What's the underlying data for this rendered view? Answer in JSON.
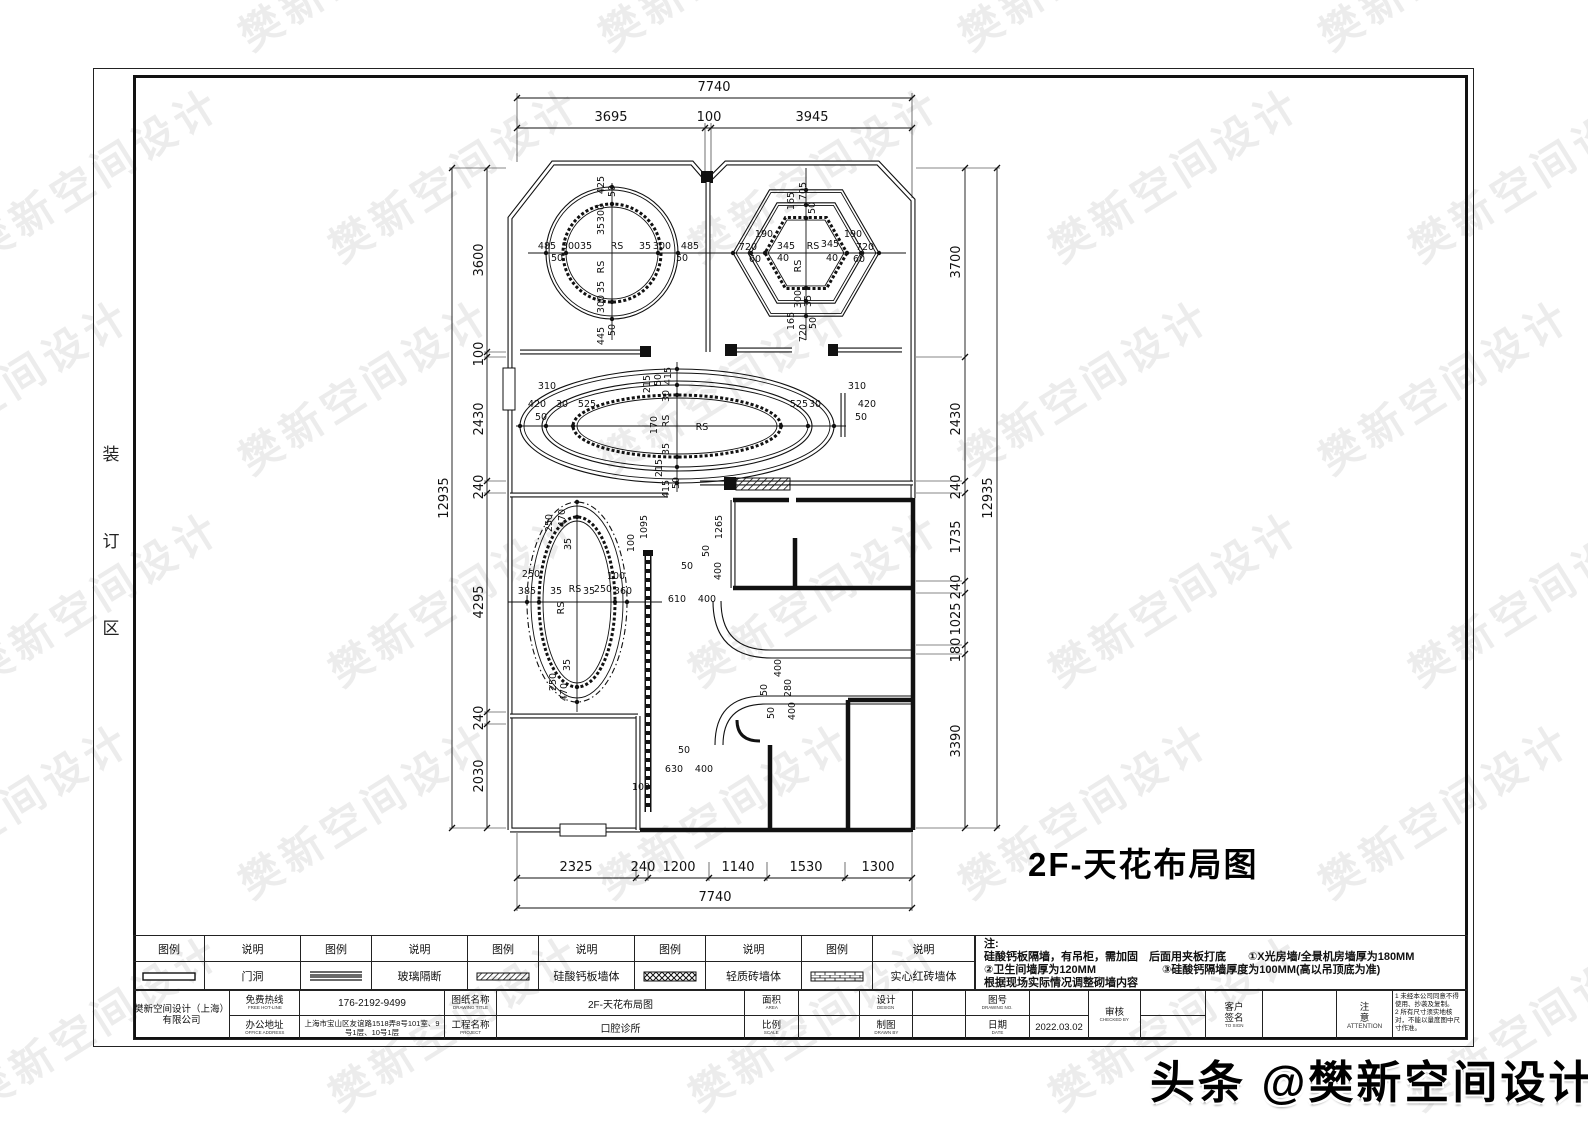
{
  "page": {
    "title_main": "2F-天花布局图",
    "binding": [
      "装",
      "订",
      "区"
    ]
  },
  "watermark": {
    "text": "樊新空间设计",
    "badge": "头条 @樊新空间设计"
  },
  "legend": {
    "headers": {
      "symbol": "图例",
      "desc": "说明"
    },
    "items": [
      {
        "symbol": "door-opening",
        "label": "门洞"
      },
      {
        "symbol": "glass-partition",
        "label": "玻璃隔断"
      },
      {
        "symbol": "calcium-silicate-board-wall",
        "label": "硅酸钙板墙体"
      },
      {
        "symbol": "light-brick-wall",
        "label": "轻质砖墙体"
      },
      {
        "symbol": "solid-red-brick-wall",
        "label": "实心红砖墙体"
      }
    ]
  },
  "notes": {
    "title": "注:",
    "lines": [
      "硅酸钙板隔墙，有吊柜，需加固　后面用夹板打底　　①X光房墙/全景机房墙厚为180MM",
      "②卫生间墙厚为120MM　　　　　　③硅酸钙隔墙厚度为100MM(高以吊顶底为准)",
      "根据现场实际情况调整砌墙内容"
    ]
  },
  "titleblock": {
    "company_line1": "樊新空间设计（上海）",
    "company_line2": "有限公司",
    "hotline_label": "免费热线",
    "hotline_sub": "FREE HOT-LINE",
    "hotline_value": "176-2192-9499",
    "address_label": "办公地址",
    "address_sub": "OFFICE ADDRESS",
    "address_value": "上海市宝山区友谊路1518弄8号101室、9号1层、10号1层",
    "drawing_title_label": "图纸名称",
    "drawing_title_sub": "DRAWING TITLE",
    "drawing_title_value": "2F-天花布局图",
    "project_label": "工程名称",
    "project_sub": "PROJECT",
    "project_value": "口腔诊所",
    "area_label": "面积",
    "area_sub": "AREA",
    "area_value": "",
    "scale_label": "比例",
    "scale_sub": "SCALE",
    "scale_value": "",
    "design_label": "设计",
    "design_sub": "DESIGN",
    "design_value": "",
    "draft_label": "制图",
    "draft_sub": "DRAWN BY",
    "draft_value": "",
    "drawing_no_label": "图号",
    "drawing_no_sub": "DRAWING NO.",
    "drawing_no_value": "",
    "date_label": "日期",
    "date_sub": "DATE",
    "date_value": "2022.03.02",
    "check_label": "审核",
    "check_sub": "CHECKED BY",
    "client_label1": "客户",
    "client_label2": "签名",
    "client_sub": "TO SIGN",
    "attention_label1": "注",
    "attention_label2": "意",
    "attention_label3": "ATTENTION",
    "attention_note1": "1 未经本公司同意不得使用、抄袭及复制。",
    "attention_note2": "2 所有尺寸须实地核对，不能以量度图中尺寸作准。"
  },
  "plan": {
    "dim_labels": [
      {
        "t": "7740",
        "x": 714,
        "y": 91,
        "s": 13
      },
      {
        "t": "3695",
        "x": 611,
        "y": 121,
        "s": 13
      },
      {
        "t": "100",
        "x": 709,
        "y": 121,
        "s": 13
      },
      {
        "t": "3945",
        "x": 812,
        "y": 121,
        "s": 13
      },
      {
        "t": "2325",
        "x": 576,
        "y": 871,
        "s": 13
      },
      {
        "t": "240",
        "x": 643,
        "y": 871,
        "s": 13
      },
      {
        "t": "1200",
        "x": 679,
        "y": 871,
        "s": 13
      },
      {
        "t": "1140",
        "x": 738,
        "y": 871,
        "s": 13
      },
      {
        "t": "1530",
        "x": 806,
        "y": 871,
        "s": 13
      },
      {
        "t": "1300",
        "x": 878,
        "y": 871,
        "s": 13
      },
      {
        "t": "7740",
        "x": 715,
        "y": 901,
        "s": 13
      },
      {
        "t": "3600",
        "x": 483,
        "y": 260,
        "r": 1,
        "s": 13
      },
      {
        "t": "100",
        "x": 483,
        "y": 354,
        "r": 1,
        "s": 13
      },
      {
        "t": "2430",
        "x": 483,
        "y": 419,
        "r": 1,
        "s": 13
      },
      {
        "t": "240",
        "x": 483,
        "y": 487,
        "r": 1,
        "s": 13
      },
      {
        "t": "4295",
        "x": 483,
        "y": 602,
        "r": 1,
        "s": 13
      },
      {
        "t": "240",
        "x": 483,
        "y": 718,
        "r": 1,
        "s": 13
      },
      {
        "t": "2030",
        "x": 483,
        "y": 776,
        "r": 1,
        "s": 13
      },
      {
        "t": "12935",
        "x": 448,
        "y": 498,
        "r": 1,
        "s": 13
      },
      {
        "t": "3700",
        "x": 960,
        "y": 262,
        "r": 1,
        "s": 13
      },
      {
        "t": "2430",
        "x": 960,
        "y": 419,
        "r": 1,
        "s": 13
      },
      {
        "t": "240",
        "x": 960,
        "y": 487,
        "r": 1,
        "s": 13
      },
      {
        "t": "1735",
        "x": 960,
        "y": 537,
        "r": 1,
        "s": 13
      },
      {
        "t": "240",
        "x": 960,
        "y": 587,
        "r": 1,
        "s": 13
      },
      {
        "t": "1025",
        "x": 960,
        "y": 619,
        "r": 1,
        "s": 13
      },
      {
        "t": "180",
        "x": 960,
        "y": 650,
        "r": 1,
        "s": 13
      },
      {
        "t": "3390",
        "x": 960,
        "y": 741,
        "r": 1,
        "s": 13
      },
      {
        "t": "12935",
        "x": 992,
        "y": 498,
        "r": 1,
        "s": 13
      },
      {
        "t": "425",
        "x": 604,
        "y": 185,
        "r": 1
      },
      {
        "t": "50",
        "x": 615,
        "y": 191,
        "r": 1
      },
      {
        "t": "300",
        "x": 604,
        "y": 213,
        "r": 1
      },
      {
        "t": "35",
        "x": 604,
        "y": 229,
        "r": 1
      },
      {
        "t": "485",
        "x": 547,
        "y": 249
      },
      {
        "t": "50",
        "x": 557,
        "y": 261
      },
      {
        "t": "300",
        "x": 571,
        "y": 249
      },
      {
        "t": "35",
        "x": 586,
        "y": 249
      },
      {
        "t": "RS",
        "x": 617,
        "y": 249
      },
      {
        "t": "RS",
        "x": 604,
        "y": 267,
        "r": 1
      },
      {
        "t": "35",
        "x": 645,
        "y": 249
      },
      {
        "t": "300",
        "x": 662,
        "y": 249
      },
      {
        "t": "485",
        "x": 690,
        "y": 249
      },
      {
        "t": "50",
        "x": 682,
        "y": 261
      },
      {
        "t": "35",
        "x": 604,
        "y": 287,
        "r": 1
      },
      {
        "t": "300",
        "x": 604,
        "y": 304,
        "r": 1
      },
      {
        "t": "445",
        "x": 604,
        "y": 336,
        "r": 1
      },
      {
        "t": "50",
        "x": 615,
        "y": 330,
        "r": 1
      },
      {
        "t": "165",
        "x": 794,
        "y": 201,
        "r": 1
      },
      {
        "t": "705",
        "x": 806,
        "y": 191,
        "r": 1
      },
      {
        "t": "50",
        "x": 815,
        "y": 208,
        "r": 1
      },
      {
        "t": "190",
        "x": 764,
        "y": 237
      },
      {
        "t": "720",
        "x": 748,
        "y": 250
      },
      {
        "t": "60",
        "x": 755,
        "y": 262
      },
      {
        "t": "345",
        "x": 786,
        "y": 249
      },
      {
        "t": "40",
        "x": 783,
        "y": 261
      },
      {
        "t": "RS",
        "x": 813,
        "y": 249
      },
      {
        "t": "RS",
        "x": 801,
        "y": 266,
        "r": 1
      },
      {
        "t": "345",
        "x": 830,
        "y": 247
      },
      {
        "t": "40",
        "x": 832,
        "y": 261
      },
      {
        "t": "190",
        "x": 853,
        "y": 237
      },
      {
        "t": "720",
        "x": 865,
        "y": 250
      },
      {
        "t": "60",
        "x": 859,
        "y": 262
      },
      {
        "t": "300",
        "x": 801,
        "y": 299,
        "r": 1
      },
      {
        "t": "35",
        "x": 811,
        "y": 301,
        "r": 1
      },
      {
        "t": "165",
        "x": 794,
        "y": 321,
        "r": 1
      },
      {
        "t": "720",
        "x": 806,
        "y": 333,
        "r": 1
      },
      {
        "t": "50",
        "x": 816,
        "y": 323,
        "r": 1
      },
      {
        "t": "215",
        "x": 650,
        "y": 384,
        "r": 1
      },
      {
        "t": "50",
        "x": 661,
        "y": 380,
        "r": 1
      },
      {
        "t": "415",
        "x": 671,
        "y": 376,
        "r": 1
      },
      {
        "t": "30",
        "x": 669,
        "y": 396,
        "r": 1
      },
      {
        "t": "310",
        "x": 547,
        "y": 389
      },
      {
        "t": "420",
        "x": 537,
        "y": 407
      },
      {
        "t": "30",
        "x": 562,
        "y": 407
      },
      {
        "t": "50",
        "x": 541,
        "y": 420
      },
      {
        "t": "525",
        "x": 587,
        "y": 407
      },
      {
        "t": "170",
        "x": 657,
        "y": 425,
        "r": 1
      },
      {
        "t": "RS",
        "x": 669,
        "y": 421,
        "r": 1
      },
      {
        "t": "RS",
        "x": 702,
        "y": 430
      },
      {
        "t": "525",
        "x": 799,
        "y": 407
      },
      {
        "t": "30",
        "x": 815,
        "y": 407
      },
      {
        "t": "310",
        "x": 857,
        "y": 389
      },
      {
        "t": "420",
        "x": 867,
        "y": 407
      },
      {
        "t": "50",
        "x": 861,
        "y": 420
      },
      {
        "t": "35",
        "x": 669,
        "y": 449,
        "r": 1
      },
      {
        "t": "215",
        "x": 662,
        "y": 468,
        "r": 1
      },
      {
        "t": "415",
        "x": 669,
        "y": 489,
        "r": 1
      },
      {
        "t": "50",
        "x": 679,
        "y": 483,
        "r": 1
      },
      {
        "t": "250",
        "x": 552,
        "y": 523,
        "r": 1
      },
      {
        "t": "470",
        "x": 565,
        "y": 518,
        "r": 1
      },
      {
        "t": "35",
        "x": 571,
        "y": 544,
        "r": 1
      },
      {
        "t": "250",
        "x": 531,
        "y": 577
      },
      {
        "t": "385",
        "x": 527,
        "y": 594
      },
      {
        "t": "35",
        "x": 556,
        "y": 594
      },
      {
        "t": "RS",
        "x": 575,
        "y": 592
      },
      {
        "t": "RS",
        "x": 564,
        "y": 608,
        "r": 1
      },
      {
        "t": "35",
        "x": 589,
        "y": 594
      },
      {
        "t": "250",
        "x": 603,
        "y": 592
      },
      {
        "t": "360",
        "x": 623,
        "y": 594
      },
      {
        "t": "100",
        "x": 616,
        "y": 579
      },
      {
        "t": "100",
        "x": 634,
        "y": 543,
        "r": 1
      },
      {
        "t": "1095",
        "x": 647,
        "y": 527,
        "r": 1
      },
      {
        "t": "35",
        "x": 570,
        "y": 665,
        "r": 1
      },
      {
        "t": "250",
        "x": 556,
        "y": 682,
        "r": 1
      },
      {
        "t": "470",
        "x": 567,
        "y": 692,
        "r": 1
      },
      {
        "t": "1265",
        "x": 722,
        "y": 527,
        "r": 1
      },
      {
        "t": "50",
        "x": 709,
        "y": 551,
        "r": 1
      },
      {
        "t": "400",
        "x": 721,
        "y": 571,
        "r": 1
      },
      {
        "t": "50",
        "x": 687,
        "y": 569
      },
      {
        "t": "610",
        "x": 677,
        "y": 602
      },
      {
        "t": "400",
        "x": 707,
        "y": 602
      },
      {
        "t": "400",
        "x": 781,
        "y": 668,
        "r": 1
      },
      {
        "t": "50",
        "x": 767,
        "y": 690,
        "r": 1
      },
      {
        "t": "280",
        "x": 791,
        "y": 688,
        "r": 1
      },
      {
        "t": "50",
        "x": 774,
        "y": 713,
        "r": 1
      },
      {
        "t": "400",
        "x": 795,
        "y": 711,
        "r": 1
      },
      {
        "t": "50",
        "x": 684,
        "y": 753
      },
      {
        "t": "630",
        "x": 674,
        "y": 772
      },
      {
        "t": "400",
        "x": 704,
        "y": 772
      },
      {
        "t": "100",
        "x": 641,
        "y": 790
      }
    ]
  }
}
